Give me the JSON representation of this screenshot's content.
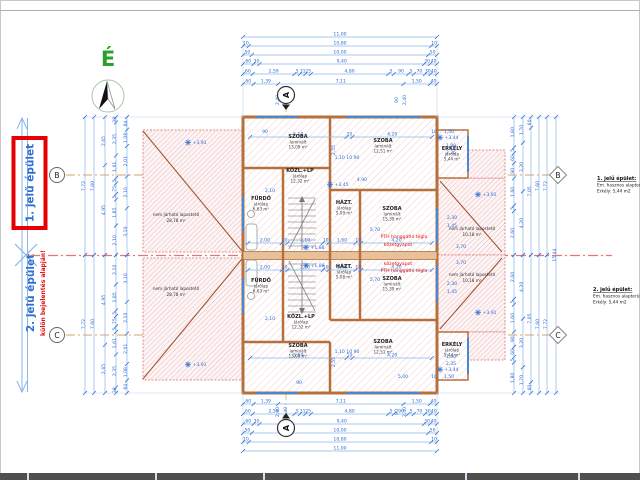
{
  "colors": {
    "dim_blue": "#2e6bd6",
    "dim_line": "#8ab6ea",
    "wall_orange": "#b5703d",
    "hatch_pink": "#eab3b3",
    "axis_red": "#e87575",
    "note_red": "#e01010",
    "grid_orange": "#d4883c",
    "north_green": "#2ca02c",
    "label_blue": "#2f6fd0",
    "highlight_red": "#e60000"
  },
  "north": {
    "label": "É"
  },
  "left_panel": {
    "building1": {
      "label": "1. jelű épület"
    },
    "building2": {
      "label": "2. jelű épület",
      "note": "külön bejelentés alapján!"
    }
  },
  "grid": {
    "section_label": "A",
    "left_markers": [
      {
        "label": "B"
      },
      {
        "label": "C"
      }
    ],
    "right_markers": [
      {
        "label": "B"
      },
      {
        "label": "C"
      }
    ]
  },
  "legend_blocks": [
    {
      "title": "1. jelű épület:",
      "line1": "Em. hasznos alapterület:",
      "line2": "Erkély: 5,44 m2"
    },
    {
      "title": "2. jelű épület:",
      "line1": "Em. hasznos alapterület:",
      "line2": "Erkély: 5,44 m2"
    }
  ],
  "plan": {
    "rooms": [
      {
        "x": 298,
        "y": 138,
        "name": "SZOBA",
        "finish": "laminált",
        "area": "13,09 m²"
      },
      {
        "x": 383,
        "y": 142,
        "name": "SZOBA",
        "finish": "laminált",
        "area": "12,51 m²"
      },
      {
        "x": 300,
        "y": 172,
        "name": "KÖZL.+LP",
        "finish": "járólap",
        "area": "12,32 m²"
      },
      {
        "x": 261,
        "y": 200,
        "name": "FÜRDŐ",
        "finish": "járólap",
        "area": "6,63 m²"
      },
      {
        "x": 344,
        "y": 204,
        "name": "HÁZT.",
        "finish": "járólap",
        "area": "5,09 m²"
      },
      {
        "x": 392,
        "y": 210,
        "name": "SZOBA",
        "finish": "laminált",
        "area": "15,39 m²"
      },
      {
        "x": 452,
        "y": 150,
        "name": "ERKÉLY",
        "finish": "járólap",
        "area": "5,44 m²"
      },
      {
        "x": 261,
        "y": 282,
        "name": "FÜRDŐ",
        "finish": "járólap",
        "area": "6,63 m²"
      },
      {
        "x": 344,
        "y": 268,
        "name": "HÁZT.",
        "finish": "járólap",
        "area": "5,08 m²"
      },
      {
        "x": 392,
        "y": 280,
        "name": "SZOBA",
        "finish": "laminált",
        "area": "15,39 m²"
      },
      {
        "x": 301,
        "y": 318,
        "name": "KÖZL.+LP",
        "finish": "járólap",
        "area": "12,32 m²"
      },
      {
        "x": 298,
        "y": 347,
        "name": "SZOBA",
        "finish": "laminált",
        "area": "13,09 m²"
      },
      {
        "x": 383,
        "y": 343,
        "name": "SZOBA",
        "finish": "laminált",
        "area": "12,51 m²"
      },
      {
        "x": 452,
        "y": 346,
        "name": "ERKÉLY",
        "finish": "járólap",
        "area": "5,44 m²"
      }
    ],
    "roofs": [
      {
        "x": 176,
        "y": 216,
        "label": "nem járható lapostető",
        "area": "28,78 m²"
      },
      {
        "x": 176,
        "y": 290,
        "label": "nem járható lapostető",
        "area": "28,78 m²"
      },
      {
        "x": 472,
        "y": 230,
        "label": "nem járható lapostető",
        "area": "10,18 m²"
      },
      {
        "x": 472,
        "y": 276,
        "label": "nem járható lapostető",
        "area": "10,18 m²"
      }
    ],
    "annotations": [
      {
        "x": 188,
        "y": 144,
        "t": "+3,91",
        "star": 1
      },
      {
        "x": 188,
        "y": 366,
        "t": "+3,91",
        "star": 1
      },
      {
        "x": 478,
        "y": 196,
        "t": "+3,91",
        "star": 1
      },
      {
        "x": 478,
        "y": 314,
        "t": "+3,91",
        "star": 1
      },
      {
        "x": 440,
        "y": 139,
        "t": "+3,44",
        "star": 1
      },
      {
        "x": 440,
        "y": 371,
        "t": "+3,44",
        "star": 1
      },
      {
        "x": 330,
        "y": 186,
        "t": "+3,45",
        "star": 1
      },
      {
        "x": 306,
        "y": 249,
        "t": "+1,88",
        "star": 1
      },
      {
        "x": 306,
        "y": 267,
        "t": "+1,88",
        "star": 1
      },
      {
        "x": 404,
        "y": 238,
        "t": "PTH hanggátló tégla",
        "c": "r"
      },
      {
        "x": 398,
        "y": 246,
        "t": "kőzetgyapot",
        "c": "r"
      },
      {
        "x": 398,
        "y": 265,
        "t": "kőzetgyapot",
        "c": "r"
      },
      {
        "x": 404,
        "y": 272,
        "t": "PTH hanggátló tégla",
        "c": "r"
      },
      {
        "x": 451,
        "y": 147,
        "t": "1,80"
      },
      {
        "x": 451,
        "y": 154,
        "t": "2,35"
      },
      {
        "x": 451,
        "y": 358,
        "t": "1,80"
      },
      {
        "x": 451,
        "y": 365,
        "t": "2,35"
      },
      {
        "x": 452,
        "y": 219,
        "t": "2,30"
      },
      {
        "x": 452,
        "y": 227,
        "t": "1,45"
      },
      {
        "x": 452,
        "y": 285,
        "t": "2,30"
      },
      {
        "x": 452,
        "y": 293,
        "t": "1,45"
      },
      {
        "x": 375,
        "y": 231,
        "t": "5,70"
      },
      {
        "x": 375,
        "y": 281,
        "t": "5,70"
      },
      {
        "x": 461,
        "y": 248,
        "t": "3,70"
      },
      {
        "x": 461,
        "y": 264,
        "t": "3,70"
      },
      {
        "x": 270,
        "y": 192,
        "t": "2,10"
      },
      {
        "x": 270,
        "y": 320,
        "t": "2,10"
      },
      {
        "x": 362,
        "y": 181,
        "t": "4,90"
      },
      {
        "x": 347,
        "y": 159,
        "t": "1,10  10  90"
      },
      {
        "x": 347,
        "y": 353,
        "t": "1,10  10  90"
      },
      {
        "x": 335,
        "y": 150,
        "t": "2,55",
        "rot": 1
      },
      {
        "x": 335,
        "y": 362,
        "t": "2,55",
        "rot": 1
      },
      {
        "x": 403,
        "y": 378,
        "t": "5,00"
      },
      {
        "x": 265,
        "y": 133,
        "t": "90"
      },
      {
        "x": 299,
        "y": 384,
        "t": "90"
      },
      {
        "x": 434,
        "y": 133,
        "t": "10"
      },
      {
        "x": 449,
        "y": 133,
        "t": "1,50"
      },
      {
        "x": 434,
        "y": 378,
        "t": "10"
      },
      {
        "x": 449,
        "y": 378,
        "t": "1,50"
      },
      {
        "x": 279,
        "y": 100,
        "t": "2,40",
        "rot": 1
      },
      {
        "x": 287,
        "y": 100,
        "t": "1,40",
        "rot": 1
      },
      {
        "x": 279,
        "y": 412,
        "t": "2,40",
        "rot": 1
      },
      {
        "x": 287,
        "y": 412,
        "t": "1,40",
        "rot": 1
      },
      {
        "x": 398,
        "y": 100,
        "t": "90",
        "rot": 1
      },
      {
        "x": 406,
        "y": 100,
        "t": "2,40",
        "rot": 1
      },
      {
        "x": 398,
        "y": 412,
        "t": "90",
        "rot": 1
      },
      {
        "x": 406,
        "y": 412,
        "t": "2,40",
        "rot": 1
      }
    ],
    "chains": [
      {
        "o": "h",
        "pos": 37,
        "from": 243,
        "to": 437,
        "vals": [
          "11,00"
        ]
      },
      {
        "o": "h",
        "pos": 46,
        "from": 243,
        "to": 437,
        "vals": [
          "10",
          "10,80",
          "10"
        ]
      },
      {
        "o": "h",
        "pos": 55,
        "from": 243,
        "to": 437,
        "vals": [
          "50",
          "10,00",
          "50"
        ]
      },
      {
        "o": "h",
        "pos": 64,
        "from": 243,
        "to": 437,
        "vals": [
          "60",
          "30",
          "9,40",
          "30",
          "40"
        ]
      },
      {
        "o": "h",
        "pos": 74,
        "from": 243,
        "to": 437,
        "vals": [
          "60",
          "2,59",
          "5",
          "31",
          "25",
          "4,80",
          "5",
          "90",
          "5",
          "70",
          "30",
          "40"
        ]
      },
      {
        "o": "h",
        "pos": 84,
        "from": 243,
        "to": 437,
        "vals": [
          "60",
          "1,39",
          "7,11",
          "1,50",
          "40"
        ]
      },
      {
        "o": "h",
        "pos": 404,
        "from": 243,
        "to": 437,
        "vals": [
          "60",
          "1,39",
          "7,11",
          "1,50",
          "40"
        ]
      },
      {
        "o": "h",
        "pos": 414,
        "from": 243,
        "to": 437,
        "vals": [
          "60",
          "2,59",
          "5",
          "31",
          "25",
          "4,80",
          "5",
          "90",
          "5",
          "70",
          "30",
          "40"
        ]
      },
      {
        "o": "h",
        "pos": 424,
        "from": 243,
        "to": 437,
        "vals": [
          "60",
          "30",
          "9,40",
          "30",
          "40"
        ]
      },
      {
        "o": "h",
        "pos": 433,
        "from": 243,
        "to": 437,
        "vals": [
          "50",
          "10,00",
          "50"
        ]
      },
      {
        "o": "h",
        "pos": 442,
        "from": 243,
        "to": 437,
        "vals": [
          "10",
          "10,80",
          "10"
        ]
      },
      {
        "o": "h",
        "pos": 451,
        "from": 243,
        "to": 437,
        "vals": [
          "11,00"
        ]
      },
      {
        "o": "v",
        "pos": 85,
        "from": 117,
        "to": 255,
        "vals": [
          "7,72"
        ]
      },
      {
        "o": "v",
        "pos": 94,
        "from": 117,
        "to": 255,
        "vals": [
          "7,60"
        ]
      },
      {
        "o": "v",
        "pos": 105,
        "from": 117,
        "to": 255,
        "vals": [
          "2,65",
          "4,95"
        ]
      },
      {
        "o": "v",
        "pos": 116,
        "from": 117,
        "to": 255,
        "vals": [
          "30",
          "2,35",
          "1,61",
          "5",
          "75",
          "5",
          "1,85",
          "2,10"
        ]
      },
      {
        "o": "v",
        "pos": 127,
        "from": 117,
        "to": 255,
        "vals": [
          "84",
          "1,08",
          "2,01",
          "2,10",
          "3,10"
        ]
      },
      {
        "o": "v",
        "pos": 85,
        "from": 255,
        "to": 393,
        "vals": [
          "7,72"
        ]
      },
      {
        "o": "v",
        "pos": 94,
        "from": 255,
        "to": 393,
        "vals": [
          "7,60"
        ]
      },
      {
        "o": "v",
        "pos": 105,
        "from": 255,
        "to": 393,
        "vals": [
          "4,95",
          "2,65"
        ]
      },
      {
        "o": "v",
        "pos": 116,
        "from": 255,
        "to": 393,
        "vals": [
          "2,10",
          "1,85",
          "5",
          "75",
          "5",
          "1,61",
          "2,35",
          "30"
        ]
      },
      {
        "o": "v",
        "pos": 127,
        "from": 255,
        "to": 393,
        "vals": [
          "3,10",
          "2,10",
          "2,01",
          "1,08",
          "84"
        ]
      },
      {
        "o": "v",
        "pos": 514,
        "from": 117,
        "to": 255,
        "vals": [
          "1,80",
          "5",
          "60",
          "90",
          "1,60",
          "5",
          "2,60"
        ]
      },
      {
        "o": "v",
        "pos": 523,
        "from": 117,
        "to": 255,
        "vals": [
          "1,70",
          "3,20",
          "4,20"
        ]
      },
      {
        "o": "v",
        "pos": 531,
        "from": 117,
        "to": 255,
        "vals": [
          "60",
          "7,05"
        ]
      },
      {
        "o": "v",
        "pos": 539,
        "from": 117,
        "to": 255,
        "vals": [
          "7,60"
        ]
      },
      {
        "o": "v",
        "pos": 547,
        "from": 117,
        "to": 255,
        "vals": [
          "7,72"
        ]
      },
      {
        "o": "v",
        "pos": 514,
        "from": 255,
        "to": 393,
        "vals": [
          "2,60",
          "5",
          "1,60",
          "90",
          "60",
          "5",
          "1,80"
        ]
      },
      {
        "o": "v",
        "pos": 523,
        "from": 255,
        "to": 393,
        "vals": [
          "4,20",
          "3,20",
          "1,70"
        ]
      },
      {
        "o": "v",
        "pos": 531,
        "from": 255,
        "to": 393,
        "vals": [
          "7,05",
          "60"
        ]
      },
      {
        "o": "v",
        "pos": 539,
        "from": 255,
        "to": 393,
        "vals": [
          "7,60"
        ]
      },
      {
        "o": "v",
        "pos": 547,
        "from": 255,
        "to": 393,
        "vals": [
          "7,72"
        ]
      },
      {
        "o": "v",
        "pos": 556,
        "from": 117,
        "to": 393,
        "vals": [
          "15,44"
        ]
      },
      {
        "o": "h",
        "pos": 137,
        "from": 250,
        "to": 432,
        "vals": [
          "5,10",
          "10",
          "4,20"
        ]
      },
      {
        "o": "h",
        "pos": 358,
        "from": 250,
        "to": 432,
        "vals": [
          "5,10",
          "10",
          "4,20"
        ]
      },
      {
        "o": "h",
        "pos": 243,
        "from": 248,
        "to": 432,
        "vals": [
          "2,00",
          "10",
          "2,10",
          "10",
          "1,60",
          "10",
          "4,20"
        ]
      },
      {
        "o": "h",
        "pos": 270,
        "from": 248,
        "to": 432,
        "vals": [
          "2,00",
          "10",
          "2,10",
          "10",
          "1,60",
          "10",
          "4,20"
        ]
      }
    ]
  }
}
